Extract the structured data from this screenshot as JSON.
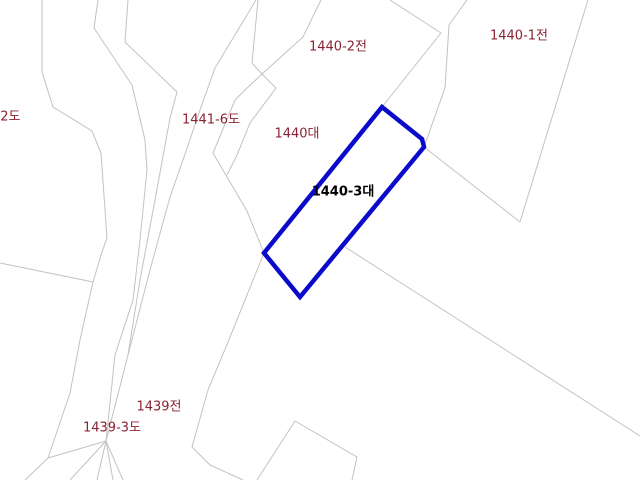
{
  "map": {
    "colors": {
      "background": "#ffffff",
      "boundary": "#c2c2c2",
      "label": "#8b2232",
      "selected_label": "#000000",
      "selected_outline": "#0a0acd"
    },
    "region_labels": [
      {
        "text": "-2도",
        "x": 8,
        "y": 116,
        "selected": false
      },
      {
        "text": "1441-6도",
        "x": 211,
        "y": 119,
        "selected": false
      },
      {
        "text": "1440대",
        "x": 297,
        "y": 133,
        "selected": false
      },
      {
        "text": "1440-2전",
        "x": 338,
        "y": 46,
        "selected": false
      },
      {
        "text": "1440-1전",
        "x": 519,
        "y": 35,
        "selected": false
      },
      {
        "text": "1440-3대",
        "x": 343,
        "y": 191,
        "selected": true
      },
      {
        "text": "1439전",
        "x": 159,
        "y": 406,
        "selected": false
      },
      {
        "text": "1439-3도",
        "x": 112,
        "y": 427,
        "selected": false
      }
    ],
    "selected_parcel": {
      "label": "1440-3대",
      "outline": [
        [
          382,
          107
        ],
        [
          422,
          139
        ],
        [
          424,
          147
        ],
        [
          300,
          297
        ],
        [
          264,
          253
        ]
      ]
    },
    "boundaries": [
      [
        [
          42,
          0
        ],
        [
          42,
          72
        ],
        [
          53,
          107
        ],
        [
          92,
          131
        ],
        [
          101,
          153
        ],
        [
          107,
          238
        ],
        [
          102,
          252
        ],
        [
          93,
          282
        ]
      ],
      [
        [
          0,
          263
        ],
        [
          93,
          282
        ]
      ],
      [
        [
          93,
          282
        ],
        [
          80,
          340
        ],
        [
          70,
          393
        ],
        [
          48,
          458
        ]
      ],
      [
        [
          48,
          458
        ],
        [
          25,
          480
        ]
      ],
      [
        [
          48,
          458
        ],
        [
          106,
          441
        ]
      ],
      [
        [
          98,
          0
        ],
        [
          94,
          28
        ],
        [
          132,
          85
        ],
        [
          145,
          140
        ],
        [
          147,
          170
        ],
        [
          140,
          240
        ],
        [
          133,
          300
        ],
        [
          115,
          355
        ],
        [
          106,
          441
        ]
      ],
      [
        [
          128,
          0
        ],
        [
          125,
          42
        ],
        [
          177,
          92
        ],
        [
          170,
          118
        ],
        [
          155,
          200
        ],
        [
          140,
          280
        ],
        [
          128,
          355
        ],
        [
          106,
          441
        ]
      ],
      [
        [
          256,
          0
        ],
        [
          215,
          68
        ],
        [
          200,
          110
        ],
        [
          183,
          160
        ],
        [
          170,
          197
        ],
        [
          150,
          270
        ],
        [
          128,
          355
        ]
      ],
      [
        [
          106,
          441
        ],
        [
          70,
          480
        ]
      ],
      [
        [
          106,
          441
        ],
        [
          97,
          480
        ]
      ],
      [
        [
          106,
          441
        ],
        [
          113,
          480
        ]
      ],
      [
        [
          106,
          441
        ],
        [
          123,
          480
        ]
      ],
      [
        [
          262,
          74
        ],
        [
          245,
          90
        ],
        [
          235,
          100
        ],
        [
          213,
          153
        ],
        [
          227,
          177
        ],
        [
          247,
          211
        ],
        [
          264,
          253
        ]
      ],
      [
        [
          262,
          74
        ],
        [
          276,
          88
        ],
        [
          250,
          123
        ],
        [
          237,
          155
        ],
        [
          227,
          175
        ]
      ],
      [
        [
          258,
          0
        ],
        [
          252,
          63
        ],
        [
          262,
          74
        ]
      ],
      [
        [
          262,
          74
        ],
        [
          303,
          37
        ],
        [
          321,
          0
        ]
      ],
      [
        [
          390,
          0
        ],
        [
          441,
          33
        ]
      ],
      [
        [
          441,
          33
        ],
        [
          382,
          107
        ]
      ],
      [
        [
          467,
          0
        ],
        [
          449,
          25
        ],
        [
          445,
          88
        ],
        [
          424,
          147
        ]
      ],
      [
        [
          424,
          147
        ],
        [
          520,
          222
        ]
      ],
      [
        [
          588,
          0
        ],
        [
          520,
          222
        ]
      ],
      [
        [
          264,
          253
        ],
        [
          228,
          342
        ],
        [
          208,
          390
        ],
        [
          192,
          447
        ],
        [
          210,
          465
        ],
        [
          243,
          480
        ]
      ],
      [
        [
          345,
          247
        ],
        [
          640,
          436
        ]
      ],
      [
        [
          257,
          480
        ],
        [
          295,
          421
        ],
        [
          357,
          457
        ],
        [
          352,
          480
        ]
      ]
    ]
  }
}
